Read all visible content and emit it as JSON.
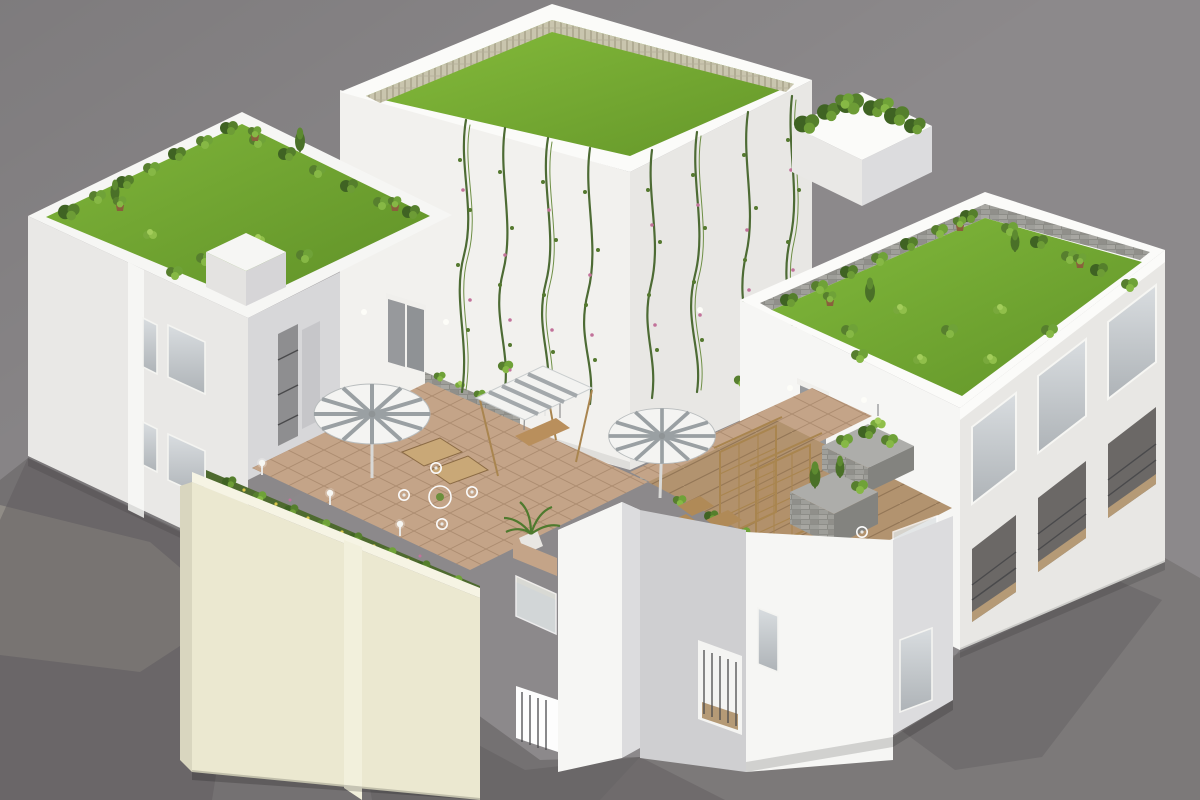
{
  "image": {
    "type": "3d-architectural-render",
    "subject": "Isometric aerial 3D rendering of a white modern residential complex with rooftop gardens, grass roofs, vine-covered central tower, tiled courtyard terrace with parasols, swing, pergola seating, planters and balconies on a gray ground",
    "width": 1200,
    "height": 800
  },
  "palette": {
    "background": "#8c898b",
    "ground_left": "#747172",
    "ground_right": "#7c7979",
    "ground_light": "#938f88",
    "shadow": "#5f5c5e",
    "wall_bright": "#fbfbf9",
    "wall_white": "#f6f6f4",
    "wall_light": "#e9e8e6",
    "wall_face": "#f2f1ee",
    "wall_warm": "#e8e7e4",
    "wall_mid": "#dcdcde",
    "wall_shade": "#d7d7d9",
    "wall_dark": "#cfcfd1",
    "cream": "#ebe8d0",
    "cream_light": "#f6f4e4",
    "cream_dark": "#d9d6bf",
    "tile": "#c4a488",
    "wood_deck": "#b2936f",
    "wood": "#a9854f",
    "grass": "#76ab2e",
    "grass_light": "#8cc43d",
    "grass_dark": "#5f9027",
    "foliage_dark": "#3f6323",
    "foliage_mid": "#6fa238",
    "foliage_light": "#90bf4a",
    "flower_pink": "#c2729a",
    "flower_yellow": "#d9c74b",
    "stone": "#9e9e99",
    "glass_light": "#d9dde0",
    "glass_dark": "#aeb3b7",
    "door_gray": "#97999c",
    "rail_dark": "#4a4a4c",
    "umbrella_white": "#f4f4f2",
    "umbrella_gray": "#9aa0a3",
    "pot_brown": "#8a5f3c",
    "fence_beige": "#c9c5ae",
    "bed_green": "#4e6a2f"
  },
  "scene": {
    "elements": [
      "left building with rooftop lawn garden and potted shrubs",
      "central tall block with grass roof, wicker fence and flowering climbing vines",
      "small upper planter box with dense shrubs",
      "right building with rooftop lawn garden, stone planter walls and glazed facade with balconies",
      "courtyard terrace with clay tiles and wood deck",
      "two striped parasols with loungers",
      "canopy swing",
      "white wire bistro table and chairs",
      "wooden pergola trellis seating",
      "cream parapet wall with flower bed and bollard lamps",
      "stone planter boxes",
      "stair towers with glass and metal balconies",
      "gray ground plane with cast shadows"
    ]
  }
}
